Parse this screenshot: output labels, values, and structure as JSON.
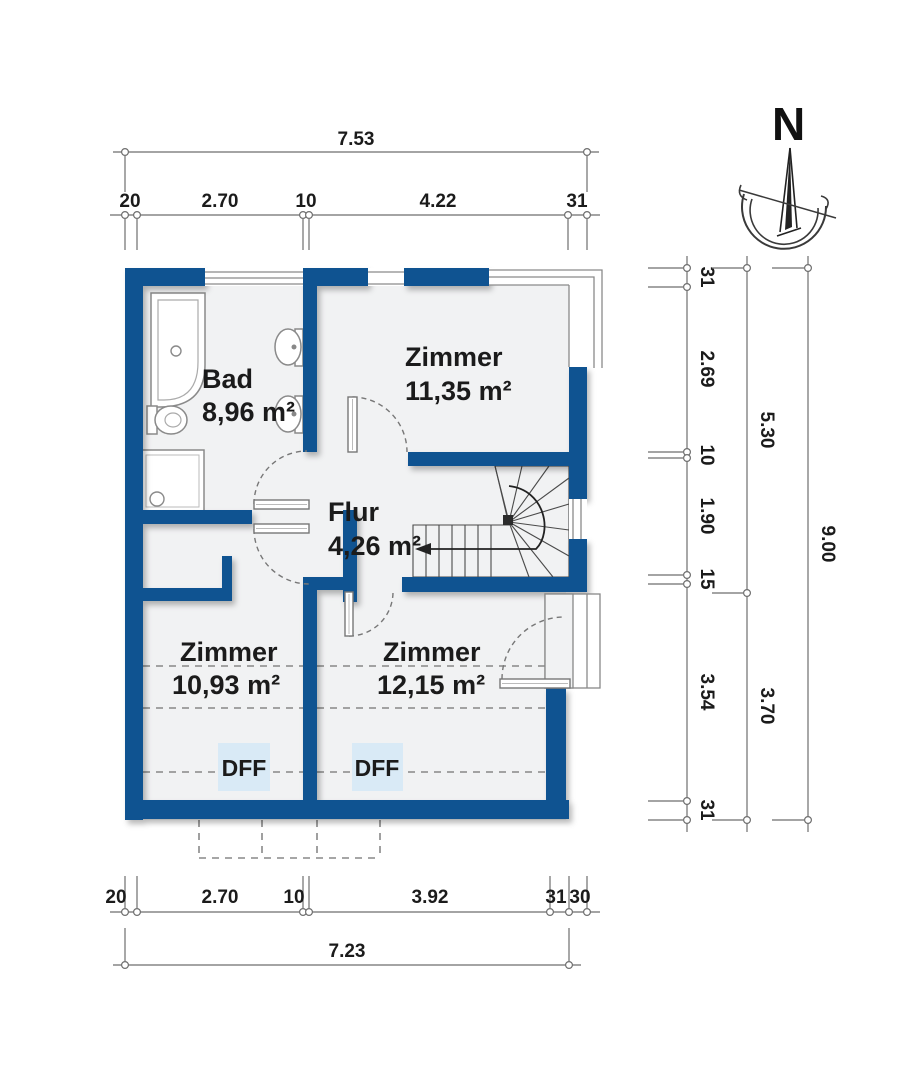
{
  "plan": {
    "compass_label": "N",
    "rooms": [
      {
        "id": "bad",
        "name": "Bad",
        "area": "8,96 m²"
      },
      {
        "id": "zimmer-ne",
        "name": "Zimmer",
        "area": "11,35 m²"
      },
      {
        "id": "flur",
        "name": "Flur",
        "area": "4,26 m²"
      },
      {
        "id": "zimmer-sw",
        "name": "Zimmer",
        "area": "10,93 m²"
      },
      {
        "id": "zimmer-se",
        "name": "Zimmer",
        "area": "12,15 m²"
      }
    ],
    "roof_windows": [
      {
        "label": "DFF"
      },
      {
        "label": "DFF"
      }
    ]
  },
  "dimensions": {
    "top": {
      "overall": "7.53",
      "chain": [
        "20",
        "2.70",
        "10",
        "4.22",
        "31"
      ]
    },
    "bottom": {
      "overall": "7.23",
      "chain": [
        "20",
        "2.70",
        "10",
        "3.92",
        "31",
        "30"
      ]
    },
    "right": {
      "overall": "9.00",
      "chain": [
        "31",
        "2.69",
        "10",
        "1.90",
        "15",
        "3.54",
        "31"
      ],
      "mid_chain": [
        "5.30",
        "3.70"
      ]
    }
  },
  "colors": {
    "wall": "#0F5391",
    "room_fill": "#F1F2F3",
    "dff_fill": "#D9EAF6"
  }
}
